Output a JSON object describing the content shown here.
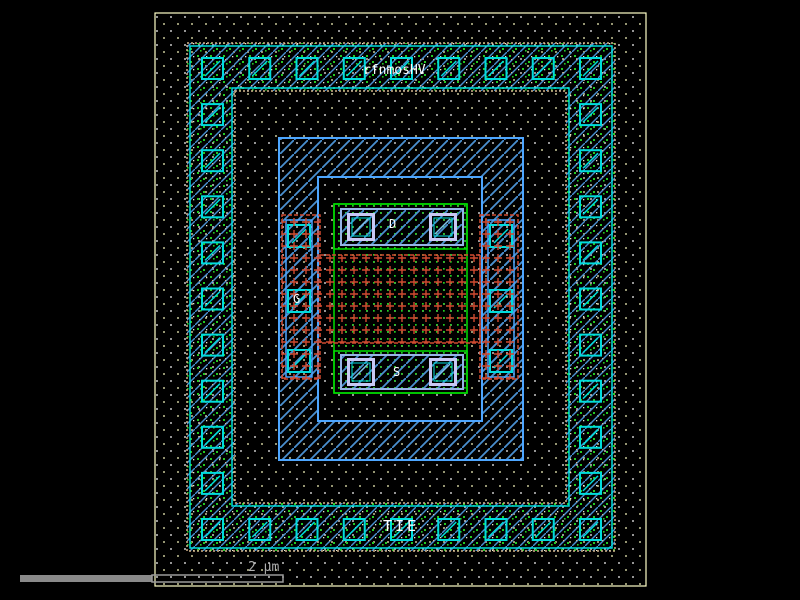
{
  "app": {
    "view": "ic-layout-canvas",
    "background": "#000000"
  },
  "cell": {
    "name": "rfnmosHV"
  },
  "terminals": {
    "drain": "D",
    "gate": "G",
    "source": "S",
    "guard_ring_tie": "TIE"
  },
  "scale_bar": {
    "label": "2 µm"
  },
  "layer_colors": {
    "boundary_outline": "#ffffc8",
    "guard_ring_border_tan": "#d2b48c",
    "contact_cyan": "#00dcdc",
    "metal_hatch_blue": "#4a90d0",
    "metal_outline_blue": "#4da6ff",
    "active_green": "#00e000",
    "active_dot_green": "#22cc22",
    "poly_red": "#cf4a30",
    "via_border_lavender": "#c8c8f4",
    "substrate_dot_white": "#ffffff",
    "substrate_dot_cream": "#ffffc4",
    "scalebar_gray": "#8a8a8a",
    "scale_text_gray": "#b0b0b0"
  }
}
